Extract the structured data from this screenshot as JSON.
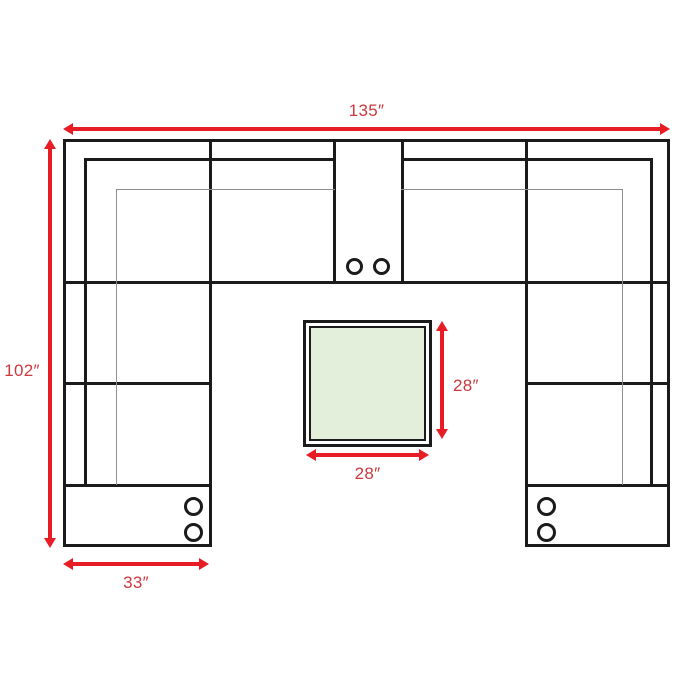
{
  "diagram": {
    "labels": {
      "overall_width": "135″",
      "overall_depth": "102″",
      "arm_section_width": "33″",
      "table_depth": "28″",
      "table_width": "28″"
    },
    "icons": {
      "cupholder": "circle"
    },
    "colors": {
      "outline": "#1b1b1b",
      "thin_line": "#8f8f8f",
      "arrow": "#e81c24",
      "label": "#cd383e",
      "table_fill": "#e3efdb",
      "background": "#ffffff"
    }
  }
}
